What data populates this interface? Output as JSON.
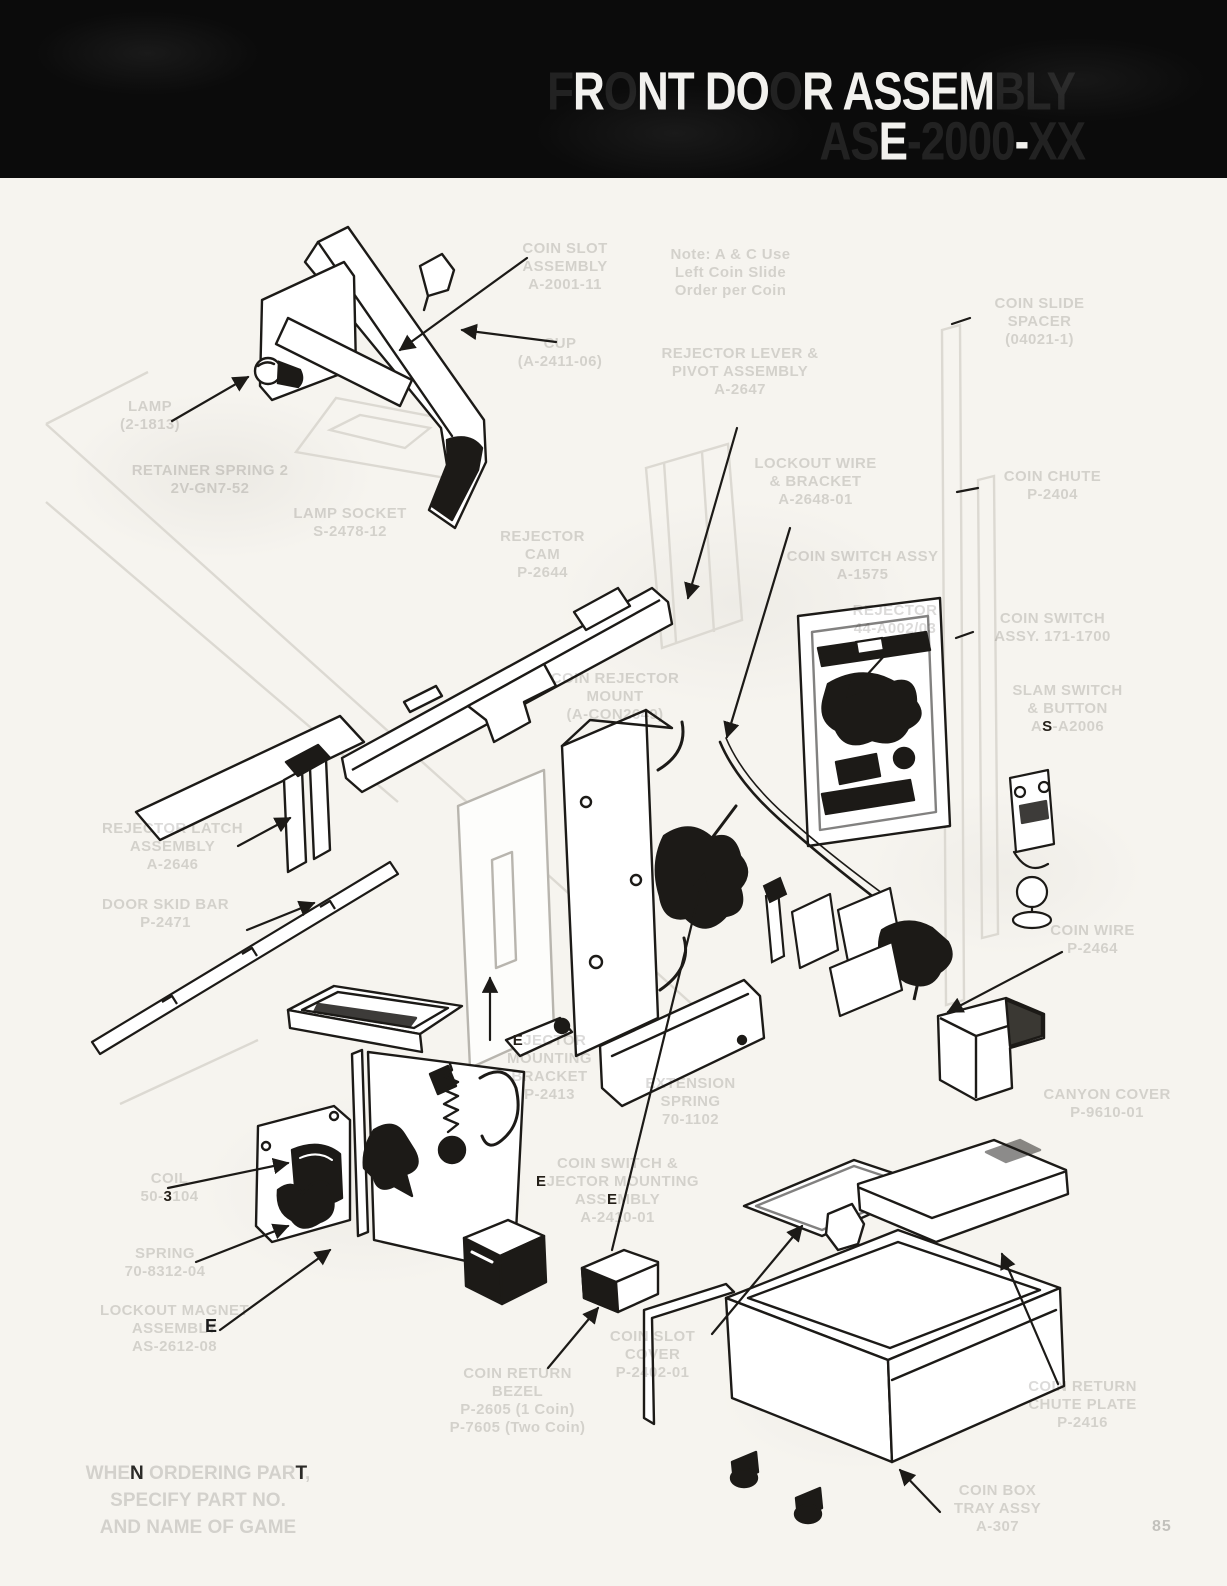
{
  "page": {
    "background": "#f6f4ef",
    "ink_color": "#1c1a17",
    "faded_label_color": "#d4d2cd",
    "header_bg": "#0b0b0b",
    "page_number": "85"
  },
  "header": {
    "line1": {
      "text": "FRONT DOOR ASSEMBLY",
      "vis": [
        0,
        1,
        0,
        1,
        1,
        0,
        1,
        1,
        0,
        1,
        0,
        1,
        1,
        1,
        1,
        1,
        0,
        0,
        0
      ]
    },
    "line2": {
      "text": "ASE-2000-XX",
      "vis": [
        0,
        0,
        1,
        0,
        0,
        0,
        0,
        0,
        1,
        0,
        0
      ]
    }
  },
  "note": {
    "lines": [
      {
        "text": "WHEN ORDERING PART,",
        "vis": [
          0,
          0,
          0,
          1,
          0,
          0,
          0,
          0,
          0,
          0,
          0,
          0,
          0,
          0,
          0,
          0,
          0,
          1,
          0
        ]
      },
      {
        "text": "SPECIFY PART NO."
      },
      {
        "text": "AND NAME OF GAME"
      }
    ]
  },
  "stray": {
    "e": "E"
  },
  "labels": {
    "coin_slot": {
      "lines": [
        {
          "text": "COIN SLOT"
        },
        {
          "text": "ASSEMBLY"
        },
        {
          "text": "A-2001-11"
        }
      ]
    },
    "note_callout": {
      "lines": [
        {
          "text": "Note: A & C Use"
        },
        {
          "text": "Left Coin Slide"
        },
        {
          "text": "Order per Coin"
        }
      ]
    },
    "cup": {
      "lines": [
        {
          "text": "CUP"
        },
        {
          "text": "(A-2411-06)"
        }
      ]
    },
    "rejector_lever": {
      "lines": [
        {
          "text": "REJECTOR LEVER &"
        },
        {
          "text": "PIVOT ASSEMBLY"
        },
        {
          "text": "A-2647"
        }
      ]
    },
    "coin_slide_spacer": {
      "lines": [
        {
          "text": "COIN SLIDE"
        },
        {
          "text": "SPACER"
        },
        {
          "text": "(04021-1)"
        }
      ]
    },
    "lamp": {
      "lines": [
        {
          "text": "LAMP"
        },
        {
          "text": "(2-1813)"
        }
      ]
    },
    "retainer_spring": {
      "lines": [
        {
          "text": "RETAINER SPRING 2"
        },
        {
          "text": "2V-GN7-52"
        }
      ]
    },
    "lamp_socket": {
      "lines": [
        {
          "text": "LAMP SOCKET"
        },
        {
          "text": "S-2478-12"
        }
      ]
    },
    "rejector_cam": {
      "lines": [
        {
          "text": "REJECTOR"
        },
        {
          "text": "CAM"
        },
        {
          "text": "P-2644"
        }
      ]
    },
    "coin_rejector_mount": {
      "lines": [
        {
          "text": "COIN REJECTOR"
        },
        {
          "text": "MOUNT"
        },
        {
          "text": "(A-CON2649)"
        }
      ]
    },
    "lockout_wire": {
      "lines": [
        {
          "text": "LOCKOUT WIRE"
        },
        {
          "text": "& BRACKET"
        },
        {
          "text": "A-2648-01"
        }
      ]
    },
    "coin_switch_a": {
      "lines": [
        {
          "text": "COIN SWITCH ASSY"
        },
        {
          "text": "A-1575"
        }
      ]
    },
    "rejector": {
      "lines": [
        {
          "text": "REJECTOR"
        },
        {
          "text": "44-A002/03"
        }
      ]
    },
    "coin_chute": {
      "lines": [
        {
          "text": "COIN CHUTE"
        },
        {
          "text": "P-2404"
        }
      ]
    },
    "coin_switch_171": {
      "lines": [
        {
          "text": "COIN SWITCH"
        },
        {
          "text": "ASSY. 171-1700"
        }
      ]
    },
    "slam_switch": {
      "lines": [
        {
          "text": "SLAM SWITCH"
        },
        {
          "text": "& BUTTON"
        },
        {
          "text": "AS-A2006",
          "vis": [
            0,
            1,
            0,
            0,
            0,
            0,
            0,
            0
          ]
        }
      ]
    },
    "rejector_latch": {
      "lines": [
        {
          "text": "REJECTOR LATCH"
        },
        {
          "text": "ASSEMBLY"
        },
        {
          "text": "A-2646"
        }
      ]
    },
    "door_skid": {
      "lines": [
        {
          "text": "DOOR SKID BAR"
        },
        {
          "text": "P-2471"
        }
      ]
    },
    "coin_wire": {
      "lines": [
        {
          "text": "COIN WIRE"
        },
        {
          "text": "P-2464"
        }
      ]
    },
    "canyon_cover": {
      "lines": [
        {
          "text": "CANYON COVER"
        },
        {
          "text": "P-9610-01"
        }
      ]
    },
    "ejector_bracket": {
      "lines": [
        {
          "text": "EJECTOR",
          "vis": [
            1,
            0,
            0,
            0,
            0,
            0,
            0
          ]
        },
        {
          "text": "MOUNTING"
        },
        {
          "text": "BRACKET"
        },
        {
          "text": "P-2413"
        }
      ]
    },
    "extension_spring": {
      "lines": [
        {
          "text": "EXTENSION"
        },
        {
          "text": "SPRING"
        },
        {
          "text": "70-1102"
        }
      ]
    },
    "coil": {
      "lines": [
        {
          "text": "COIL"
        },
        {
          "text": "50-3104",
          "vis": [
            0,
            0,
            0,
            1,
            0,
            0,
            0
          ]
        }
      ]
    },
    "spring": {
      "lines": [
        {
          "text": "SPRING"
        },
        {
          "text": "70-8312-04"
        }
      ]
    },
    "lockout_magnet": {
      "lines": [
        {
          "text": "LOCKOUT MAGNET"
        },
        {
          "text": "ASSEMBLY"
        },
        {
          "text": "AS-2612-08"
        }
      ]
    },
    "cs_ej_mount": {
      "lines": [
        {
          "text": "COIN SWITCH &"
        },
        {
          "text": "EJECTOR MOUNTING",
          "vis": [
            1,
            0,
            0,
            0,
            0,
            0,
            0,
            0,
            0,
            0,
            0,
            0,
            0,
            0,
            0,
            0
          ]
        },
        {
          "text": "ASSEMBLY",
          "vis": [
            0,
            0,
            0,
            1,
            0,
            0,
            0,
            0
          ]
        },
        {
          "text": "A-2410-01"
        }
      ]
    },
    "coin_return_bezel": {
      "lines": [
        {
          "text": "COIN RETURN"
        },
        {
          "text": "BEZEL"
        },
        {
          "text": "P-2605 (1 Coin)"
        },
        {
          "text": "P-7605 (Two Coin)"
        }
      ]
    },
    "coin_slot_cover": {
      "lines": [
        {
          "text": "COIN SLOT"
        },
        {
          "text": "COVER"
        },
        {
          "text": "P-2402-01"
        }
      ]
    },
    "coin_return_plate": {
      "lines": [
        {
          "text": "COIN RETURN"
        },
        {
          "text": "CHUTE PLATE"
        },
        {
          "text": "P-2416"
        }
      ]
    },
    "coin_box": {
      "lines": [
        {
          "text": "COIN BOX"
        },
        {
          "text": "TRAY ASSY"
        },
        {
          "text": "A-307"
        }
      ]
    }
  }
}
